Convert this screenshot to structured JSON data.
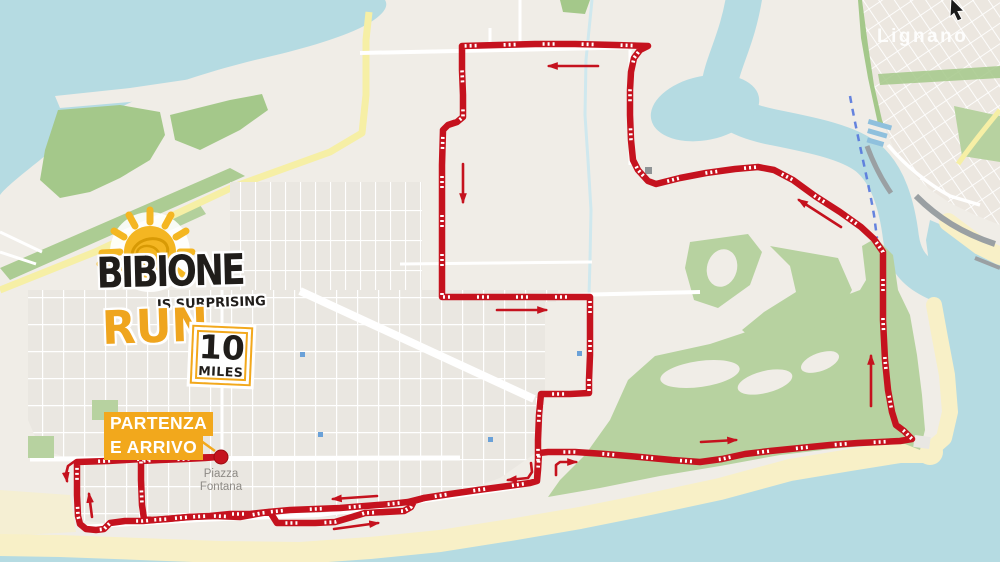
{
  "map": {
    "colors": {
      "sea": "#b5dbe2",
      "land": "#f0ede7",
      "sand": "#f8f0c7",
      "town": "#eae7e1",
      "green": "#b7d2a0",
      "green2": "#a4c88a",
      "route": "#c5121e",
      "arrow": "#c5121e",
      "gold": "#f2a81c",
      "road_yellow": "#f6efa5",
      "canal": "#cfe8ee",
      "label_gray": "#8d8a85"
    },
    "labels": {
      "lignano": "Lignano",
      "piazza_line1": "Piazza",
      "piazza_line2": "Fontana"
    }
  },
  "logo": {
    "title": "BIBIONE",
    "subtitle": "IS SURPRISING",
    "run": "RUN",
    "distance_value": "10",
    "distance_unit": "MILES"
  },
  "start_finish": {
    "line1": "PARTENZA",
    "line2": "E ARRIVO"
  },
  "route": {
    "marker": [
      221,
      457
    ],
    "leader": [
      [
        197,
        438
      ],
      [
        215,
        451
      ]
    ],
    "main": [
      [
        221,
        457
      ],
      [
        175,
        458
      ],
      [
        143,
        459
      ],
      [
        108,
        461
      ],
      [
        77,
        462
      ],
      [
        77,
        495
      ],
      [
        78,
        516
      ],
      [
        80,
        524
      ],
      [
        86,
        529
      ],
      [
        96,
        530
      ],
      [
        104,
        529
      ],
      [
        110,
        523
      ],
      [
        125,
        521
      ],
      [
        143,
        521
      ],
      [
        165,
        519
      ],
      [
        190,
        517
      ],
      [
        215,
        516
      ],
      [
        240,
        517
      ],
      [
        262,
        513
      ],
      [
        270,
        512
      ],
      [
        277,
        523
      ],
      [
        292,
        523
      ],
      [
        315,
        523
      ],
      [
        335,
        522
      ],
      [
        352,
        517
      ],
      [
        365,
        513
      ],
      [
        385,
        512
      ],
      [
        404,
        511
      ],
      [
        411,
        507
      ],
      [
        414,
        501
      ],
      [
        424,
        498
      ],
      [
        450,
        494
      ],
      [
        478,
        490
      ],
      [
        508,
        486
      ],
      [
        530,
        483
      ],
      [
        537,
        481
      ],
      [
        538,
        470
      ],
      [
        539,
        453
      ],
      [
        548,
        452
      ],
      [
        575,
        452
      ],
      [
        605,
        454
      ],
      [
        640,
        457
      ],
      [
        672,
        460
      ],
      [
        700,
        462
      ],
      [
        722,
        459
      ],
      [
        745,
        454
      ],
      [
        770,
        451
      ],
      [
        800,
        448
      ],
      [
        830,
        445
      ],
      [
        858,
        443
      ],
      [
        880,
        442
      ],
      [
        900,
        441
      ],
      [
        912,
        439
      ],
      [
        904,
        431
      ],
      [
        896,
        425
      ],
      [
        892,
        412
      ],
      [
        888,
        390
      ],
      [
        885,
        360
      ],
      [
        883,
        320
      ],
      [
        883,
        285
      ],
      [
        883,
        252
      ],
      [
        874,
        239
      ],
      [
        861,
        227
      ],
      [
        840,
        212
      ],
      [
        815,
        196
      ],
      [
        793,
        180
      ],
      [
        774,
        170
      ],
      [
        758,
        167
      ],
      [
        735,
        169
      ],
      [
        706,
        173
      ],
      [
        680,
        178
      ],
      [
        656,
        184
      ],
      [
        648,
        181
      ],
      [
        638,
        170
      ],
      [
        633,
        160
      ],
      [
        631,
        140
      ],
      [
        630,
        115
      ],
      [
        630,
        90
      ],
      [
        631,
        72
      ],
      [
        634,
        58
      ],
      [
        640,
        50
      ],
      [
        648,
        46
      ],
      [
        615,
        45
      ],
      [
        575,
        44
      ],
      [
        535,
        44
      ],
      [
        498,
        45
      ],
      [
        462,
        46
      ],
      [
        462,
        70
      ],
      [
        463,
        95
      ],
      [
        463,
        117
      ],
      [
        457,
        122
      ],
      [
        448,
        125
      ],
      [
        443,
        130
      ],
      [
        442,
        165
      ],
      [
        442,
        200
      ],
      [
        442,
        250
      ],
      [
        442,
        297
      ],
      [
        475,
        297
      ],
      [
        510,
        297
      ],
      [
        545,
        297
      ],
      [
        575,
        297
      ],
      [
        590,
        297
      ],
      [
        590,
        325
      ],
      [
        590,
        355
      ],
      [
        589,
        380
      ],
      [
        589,
        393
      ],
      [
        570,
        394
      ],
      [
        552,
        394
      ],
      [
        541,
        394
      ],
      [
        539,
        415
      ],
      [
        538,
        440
      ],
      [
        538,
        460
      ],
      [
        537,
        481
      ]
    ],
    "parallel": [
      [
        424,
        498
      ],
      [
        408,
        502
      ],
      [
        390,
        504
      ],
      [
        365,
        506
      ],
      [
        340,
        508
      ],
      [
        315,
        509
      ],
      [
        290,
        510
      ],
      [
        268,
        512
      ],
      [
        250,
        514
      ],
      [
        230,
        514
      ],
      [
        210,
        516
      ],
      [
        188,
        517
      ],
      [
        168,
        519
      ],
      [
        152,
        520
      ],
      [
        144,
        519
      ],
      [
        142,
        505
      ],
      [
        141,
        480
      ],
      [
        141,
        461
      ],
      [
        160,
        460
      ],
      [
        185,
        459
      ],
      [
        205,
        458
      ],
      [
        218,
        457
      ]
    ],
    "arrows": [
      {
        "name": "top-westbound",
        "points": [
          [
            598,
            66
          ],
          [
            549,
            66
          ]
        ]
      },
      {
        "name": "west-leg-southbound",
        "points": [
          [
            463,
            164
          ],
          [
            463,
            202
          ]
        ]
      },
      {
        "name": "mid-eastbound",
        "points": [
          [
            497,
            310
          ],
          [
            546,
            310
          ]
        ]
      },
      {
        "name": "river-northwest",
        "points": [
          [
            841,
            227
          ],
          [
            799,
            200
          ]
        ]
      },
      {
        "name": "east-leg-northbound",
        "points": [
          [
            871,
            406
          ],
          [
            871,
            356
          ]
        ]
      },
      {
        "name": "coast-eastbound",
        "points": [
          [
            701,
            442
          ],
          [
            736,
            440
          ]
        ]
      },
      {
        "name": "junction-turn-east",
        "points": [
          [
            556,
            475
          ],
          [
            556,
            465
          ],
          [
            560,
            462
          ],
          [
            576,
            462
          ]
        ]
      },
      {
        "name": "junction-turn-west",
        "points": [
          [
            531,
            463
          ],
          [
            532,
            472
          ],
          [
            528,
            478
          ],
          [
            508,
            480
          ]
        ]
      },
      {
        "name": "beach-westbound",
        "points": [
          [
            377,
            496
          ],
          [
            333,
            499
          ]
        ]
      },
      {
        "name": "beach-eastbound",
        "points": [
          [
            334,
            529
          ],
          [
            378,
            523
          ]
        ]
      },
      {
        "name": "start-turn-south",
        "points": [
          [
            75,
            461
          ],
          [
            68,
            466
          ],
          [
            66,
            474
          ],
          [
            67,
            481
          ]
        ]
      },
      {
        "name": "finish-northbound",
        "points": [
          [
            92,
            517
          ],
          [
            89,
            494
          ]
        ]
      }
    ]
  }
}
